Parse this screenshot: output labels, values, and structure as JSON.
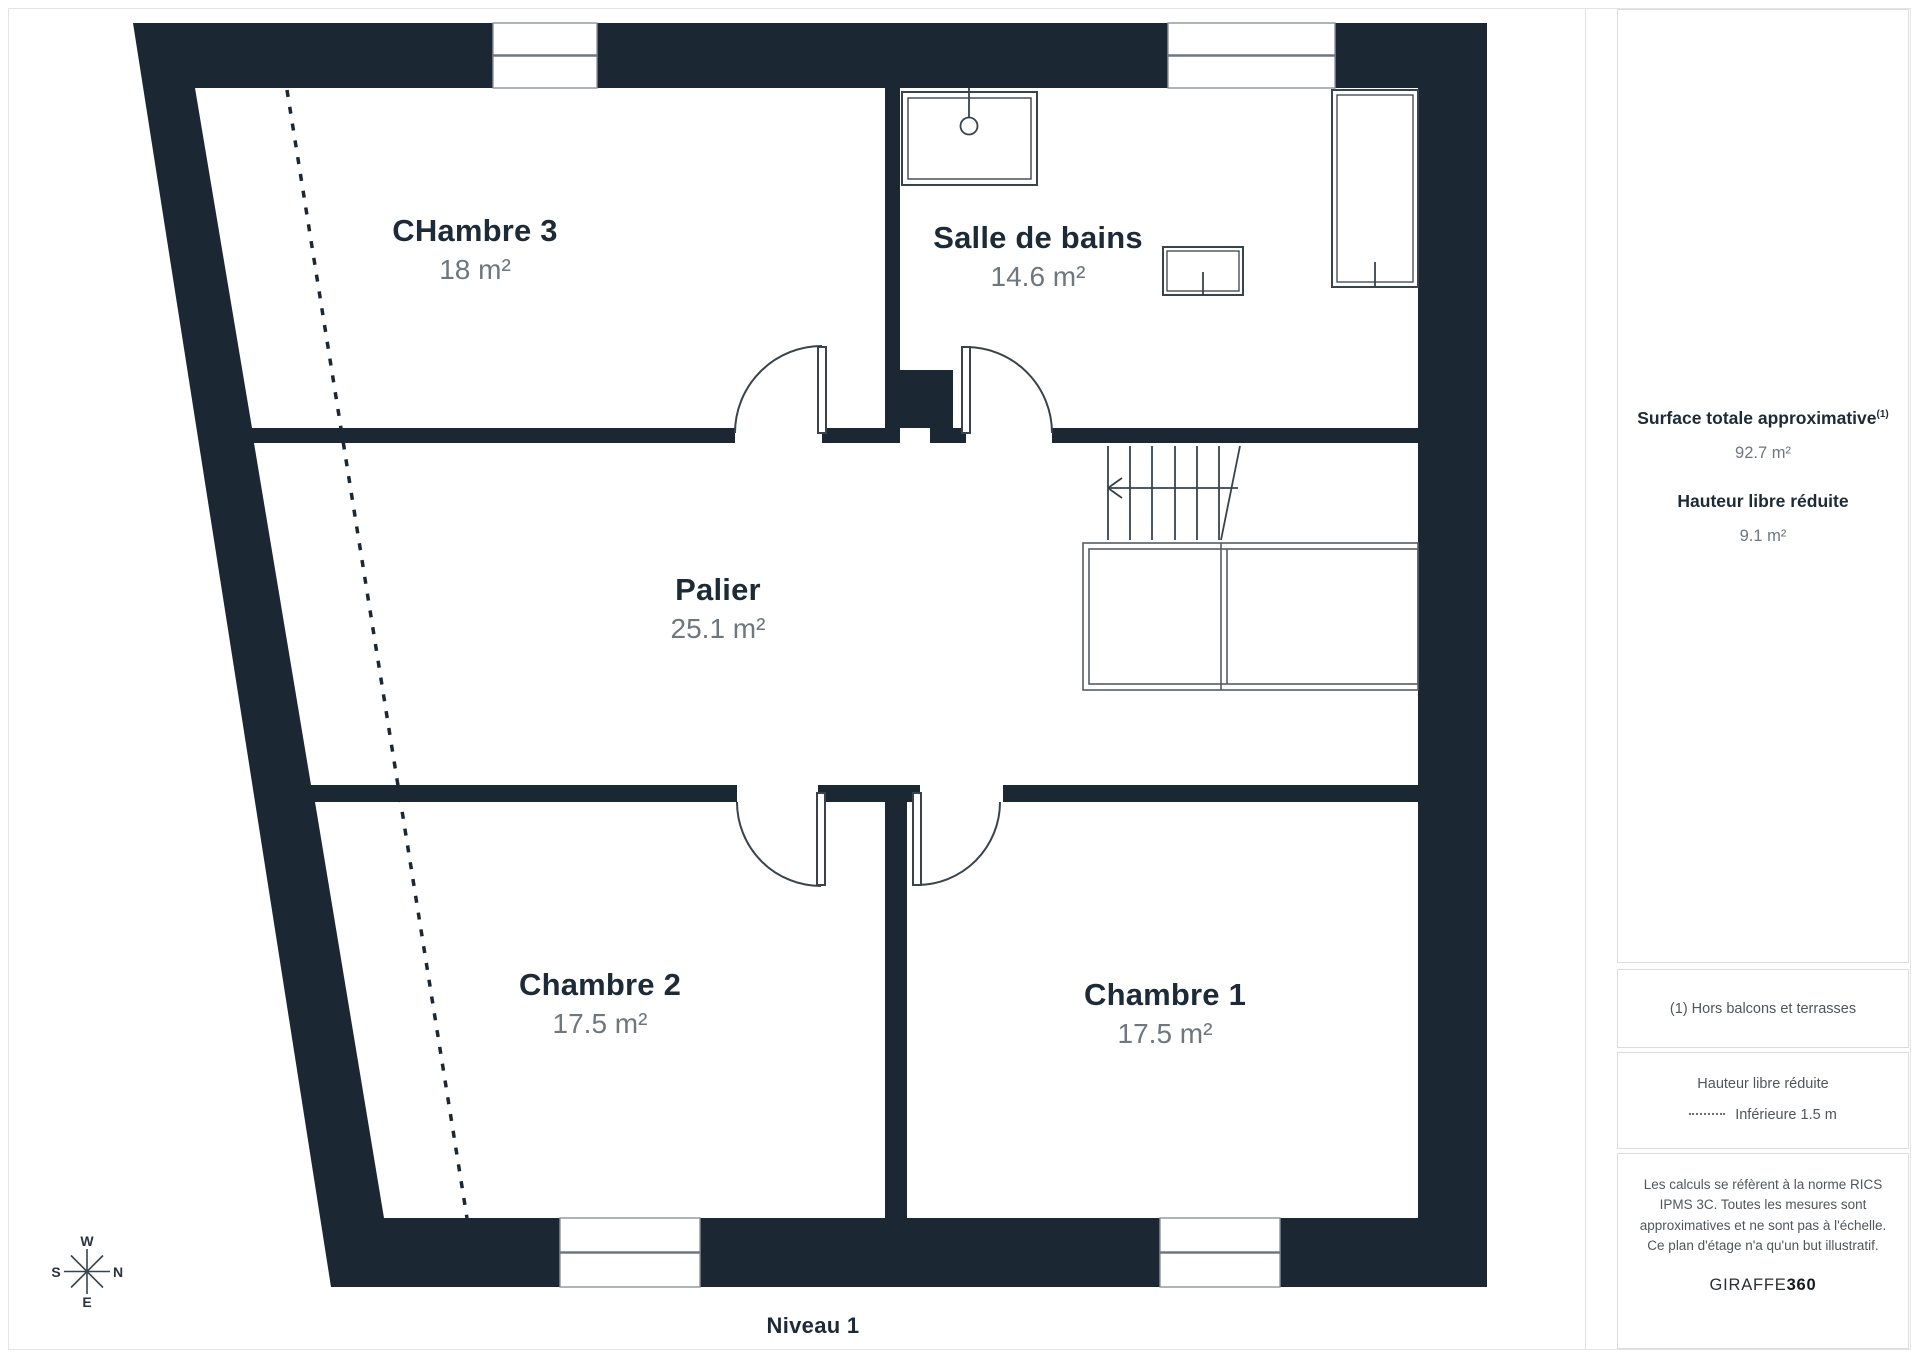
{
  "floor_label": "Niveau 1",
  "rooms": [
    {
      "name": "CHambre 3",
      "area": "18 m²"
    },
    {
      "name": "Salle de bains",
      "area": "14.6 m²"
    },
    {
      "name": "Palier",
      "area": "25.1 m²"
    },
    {
      "name": "Chambre 2",
      "area": "17.5 m²"
    },
    {
      "name": "Chambre 1",
      "area": "17.5 m²"
    }
  ],
  "sidebar": {
    "summary": {
      "total_label": "Surface totale approximative",
      "total_superscript": "(1)",
      "total_value": "92.7 m²",
      "reduced_label": "Hauteur libre réduite",
      "reduced_value": "9.1 m²"
    },
    "footnote": "(1) Hors balcons et terrasses",
    "legend": {
      "title": "Hauteur libre réduite",
      "dotted_label": "Inférieure 1.5 m"
    },
    "disclaimer": "Les calculs se réfèrent à la norme RICS IPMS 3C. Toutes les mesures sont approximatives et ne sont pas à l'échelle. Ce plan d'étage n'a qu'un but illustratif.",
    "brand": {
      "name": "GIRAFFE",
      "suffix": "360"
    }
  },
  "compass": {
    "north": "N",
    "south": "S",
    "east": "E",
    "west": "W"
  },
  "colors": {
    "wall": "#1b2732",
    "label_text": "#1d2a37",
    "muted_text": "#6e767e",
    "symbol_line": "#39434c",
    "border": "#dcdcdc"
  }
}
